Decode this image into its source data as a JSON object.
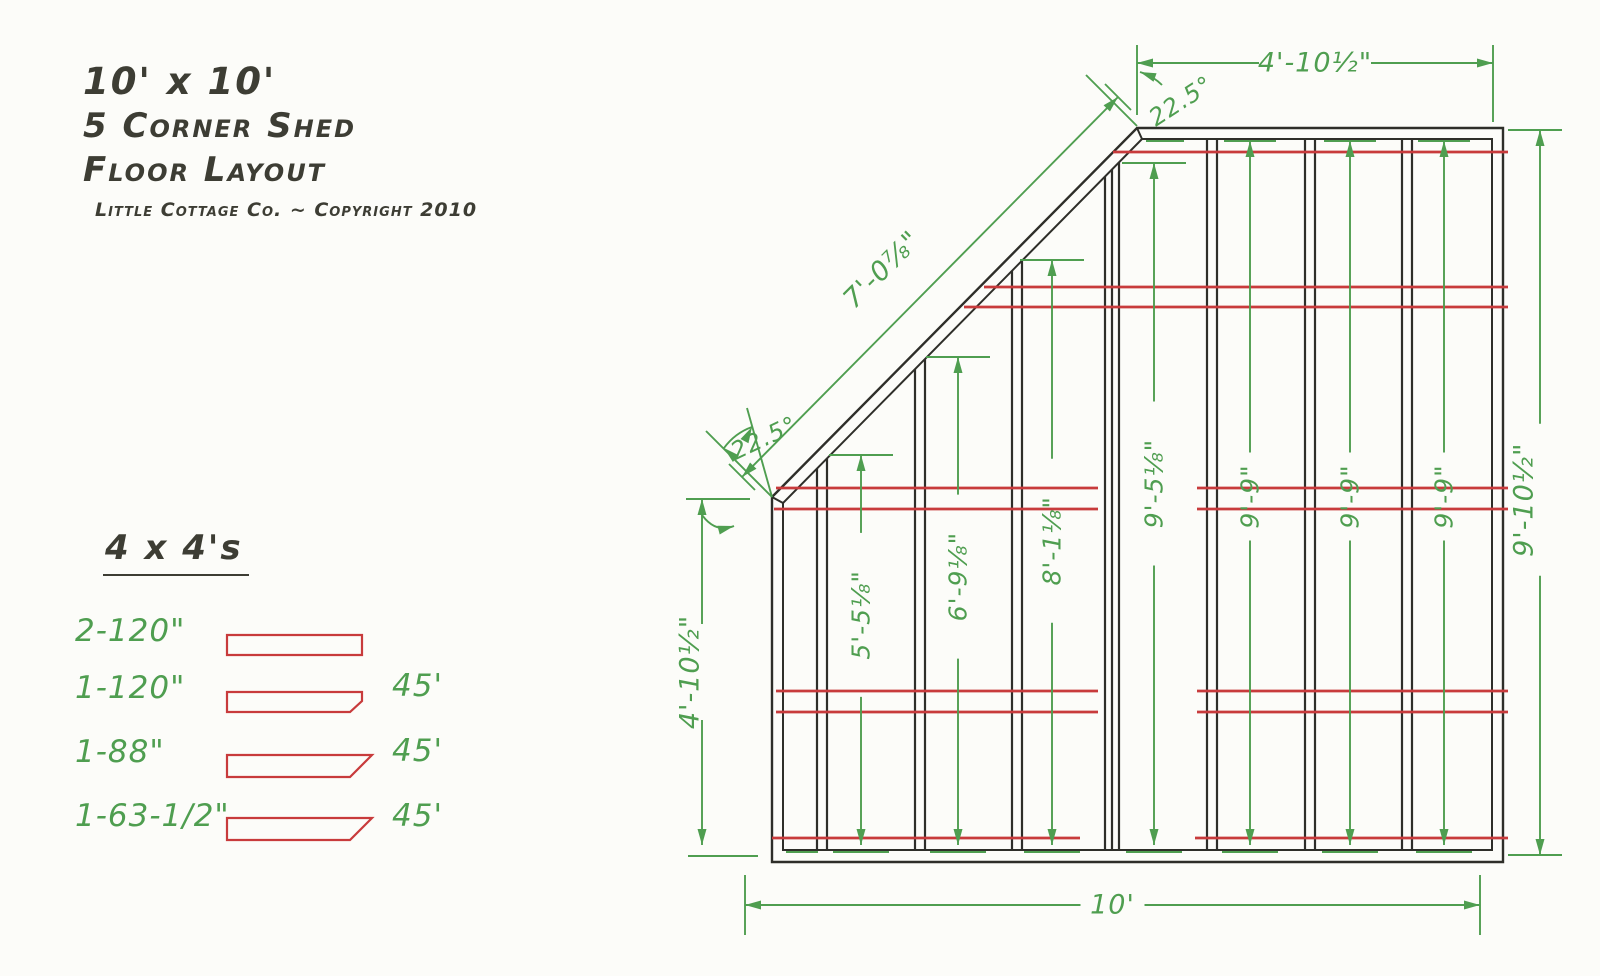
{
  "title": {
    "line1": "10' x 10'",
    "line2": "5 Corner Shed",
    "line3": "Floor Layout",
    "byline": "Little Cottage Co. ~ Copyright 2010"
  },
  "legend": {
    "heading": "4 x 4's",
    "rows": [
      {
        "label": "2-120\"",
        "note": ""
      },
      {
        "label": "1-120\"",
        "note": "45'"
      },
      {
        "label": "1-88\"",
        "note": "45'"
      },
      {
        "label": "1-63-1/2\"",
        "note": "45'"
      }
    ]
  },
  "drawing": {
    "colors": {
      "ink": "#2e2e29",
      "green": "#4f9e50",
      "red": "#c83b3c",
      "paper": "#fcfcf9"
    },
    "frame": {
      "outer": [
        [
          1137,
          128
        ],
        [
          1503,
          128
        ],
        [
          1503,
          862
        ],
        [
          772,
          862
        ],
        [
          772,
          497
        ]
      ],
      "inner": [
        [
          1142,
          139
        ],
        [
          1492,
          139
        ],
        [
          1492,
          850
        ],
        [
          783,
          850
        ],
        [
          783,
          503
        ]
      ],
      "miters": [
        [
          772,
          497,
          783,
          503
        ],
        [
          1137,
          128,
          1142,
          139
        ]
      ]
    },
    "joists": [
      [
        817,
        827
      ],
      [
        915,
        925
      ],
      [
        1012,
        1022
      ],
      [
        1105,
        1112,
        1119
      ],
      [
        1207,
        1217
      ],
      [
        1305,
        1315
      ],
      [
        1402,
        1412
      ]
    ],
    "joist_bottom": 850,
    "diag": {
      "x_at_top": 1142,
      "y_top": 139,
      "slope": 1.014
    },
    "runners": [
      {
        "y": 152,
        "segs": [
          [
            1113,
            1508
          ]
        ]
      },
      {
        "y": 287,
        "segs": [
          [
            984,
            1508
          ]
        ]
      },
      {
        "y": 307,
        "segs": [
          [
            964,
            1508
          ]
        ]
      },
      {
        "y": 488,
        "segs": [
          [
            776,
            1098
          ],
          [
            1197,
            1508
          ]
        ]
      },
      {
        "y": 509,
        "segs": [
          [
            774,
            1098
          ],
          [
            1197,
            1508
          ]
        ]
      },
      {
        "y": 691,
        "segs": [
          [
            776,
            1098
          ],
          [
            1197,
            1508
          ]
        ]
      },
      {
        "y": 712,
        "segs": [
          [
            776,
            1098
          ],
          [
            1197,
            1508
          ]
        ]
      },
      {
        "y": 838,
        "segs": [
          [
            772,
            1080
          ],
          [
            1195,
            1508
          ]
        ]
      }
    ],
    "dims": [
      {
        "p1": [
          1137,
          63
        ],
        "p2": [
          1493,
          63
        ],
        "label": "4'-10½\"",
        "t": 0.5,
        "gap": 56,
        "off": 0,
        "rot": 0,
        "size": 27
      },
      {
        "p1": [
          745,
          905
        ],
        "p2": [
          1480,
          905
        ],
        "label": "10'",
        "t": 0.5,
        "gap": 32,
        "off": 0,
        "rot": 0,
        "size": 27
      },
      {
        "p1": [
          1540,
          130
        ],
        "p2": [
          1540,
          855
        ],
        "label": "9'-10½\"",
        "t": 0.51,
        "gap": 76,
        "off": 16,
        "rot": -90,
        "size": 27
      },
      {
        "p1": [
          702,
          499
        ],
        "p2": [
          702,
          845
        ],
        "label": "4'-10½\"",
        "t": 0.5,
        "gap": 48,
        "off": 12,
        "rot": -90,
        "size": 27
      },
      {
        "p1": [
          742,
          477
        ],
        "p2": [
          1118,
          97
        ],
        "label": "7'-0⅞\"",
        "t": 0.46,
        "gap": 0,
        "off": -46,
        "rot": -45,
        "size": 27
      },
      {
        "p1": [
          861,
          455
        ],
        "p2": [
          861,
          845
        ],
        "label": "5'-5⅛\"",
        "t": 0.41,
        "gap": 82,
        "off": 0,
        "rot": -90,
        "size": 25
      },
      {
        "p1": [
          958,
          357
        ],
        "p2": [
          958,
          845
        ],
        "label": "6'-9⅛\"",
        "t": 0.45,
        "gap": 82,
        "off": 0,
        "rot": -90,
        "size": 25
      },
      {
        "p1": [
          1052,
          260
        ],
        "p2": [
          1052,
          845
        ],
        "label": "8'-1⅛\"",
        "t": 0.48,
        "gap": 82,
        "off": 0,
        "rot": -90,
        "size": 25
      },
      {
        "p1": [
          1154,
          163
        ],
        "p2": [
          1154,
          845
        ],
        "label": "9'-5⅛\"",
        "t": 0.47,
        "gap": 82,
        "off": 0,
        "rot": -90,
        "size": 25
      },
      {
        "p1": [
          1250,
          141
        ],
        "p2": [
          1250,
          845
        ],
        "label": "9'-9\"",
        "t": 0.505,
        "gap": 44,
        "off": 0,
        "rot": -90,
        "size": 25
      },
      {
        "p1": [
          1350,
          141
        ],
        "p2": [
          1350,
          845
        ],
        "label": "9'-9\"",
        "t": 0.505,
        "gap": 44,
        "off": 0,
        "rot": -90,
        "size": 25
      },
      {
        "p1": [
          1444,
          141
        ],
        "p2": [
          1444,
          845
        ],
        "label": "9'-9\"",
        "t": 0.505,
        "gap": 44,
        "off": 0,
        "rot": -90,
        "size": 25
      }
    ],
    "ticks": [
      [
        1137,
        45,
        1137,
        115
      ],
      [
        1493,
        45,
        1493,
        122
      ],
      [
        1508,
        130,
        1562,
        130
      ],
      [
        1508,
        855,
        1562,
        855
      ],
      [
        745,
        875,
        745,
        935
      ],
      [
        1480,
        875,
        1480,
        935
      ],
      [
        686,
        499,
        750,
        499
      ],
      [
        688,
        856,
        758,
        856
      ],
      [
        1105,
        84,
        1131,
        110
      ],
      [
        729,
        464,
        755,
        490
      ],
      [
        829,
        455,
        893,
        455
      ],
      [
        926,
        357,
        990,
        357
      ],
      [
        1020,
        260,
        1084,
        260
      ],
      [
        1122,
        163,
        1186,
        163
      ],
      [
        833,
        852,
        889,
        852
      ],
      [
        930,
        852,
        986,
        852
      ],
      [
        1024,
        852,
        1080,
        852
      ],
      [
        1126,
        852,
        1182,
        852
      ],
      [
        1222,
        852,
        1278,
        852
      ],
      [
        1322,
        852,
        1378,
        852
      ],
      [
        1416,
        852,
        1472,
        852
      ],
      [
        786,
        852,
        818,
        852
      ],
      [
        1224,
        141,
        1276,
        141
      ],
      [
        1324,
        141,
        1376,
        141
      ],
      [
        1418,
        141,
        1470,
        141
      ],
      [
        1146,
        141,
        1184,
        141
      ]
    ],
    "angles": [
      {
        "label": "22.5°",
        "lx": 1181,
        "ly": 101,
        "rot": -33,
        "size": 24,
        "rays": [
          [
            1137,
            126,
            1086,
            75
          ]
        ],
        "arcs": [
          "M 1140,72 Q 1153,76 1162,85"
        ],
        "arrows": [
          [
            1140,
            72,
            200
          ]
        ]
      },
      {
        "label": "22.5°",
        "lx": 764,
        "ly": 438,
        "rot": -25,
        "size": 24,
        "rays": [
          [
            772,
            497,
            706,
            431
          ],
          [
            772,
            497,
            747,
            408
          ]
        ],
        "arcs": [
          "M 752,427 Q 735,433 724,448",
          "M 700,512 Q 714,534 734,526"
        ],
        "arrows": [
          [
            752,
            427,
            -62
          ],
          [
            724,
            448,
            222
          ],
          [
            734,
            526,
            -15
          ]
        ]
      }
    ],
    "legend_shapes": [
      [
        [
          227,
          635
        ],
        [
          362,
          635
        ],
        [
          362,
          655
        ],
        [
          227,
          655
        ]
      ],
      [
        [
          227,
          692
        ],
        [
          362,
          692
        ],
        [
          362,
          701
        ],
        [
          350,
          712
        ],
        [
          227,
          712
        ]
      ],
      [
        [
          227,
          755
        ],
        [
          372,
          755
        ],
        [
          350,
          777
        ],
        [
          227,
          777
        ]
      ],
      [
        [
          227,
          818
        ],
        [
          372,
          818
        ],
        [
          350,
          840
        ],
        [
          227,
          840
        ]
      ]
    ]
  }
}
